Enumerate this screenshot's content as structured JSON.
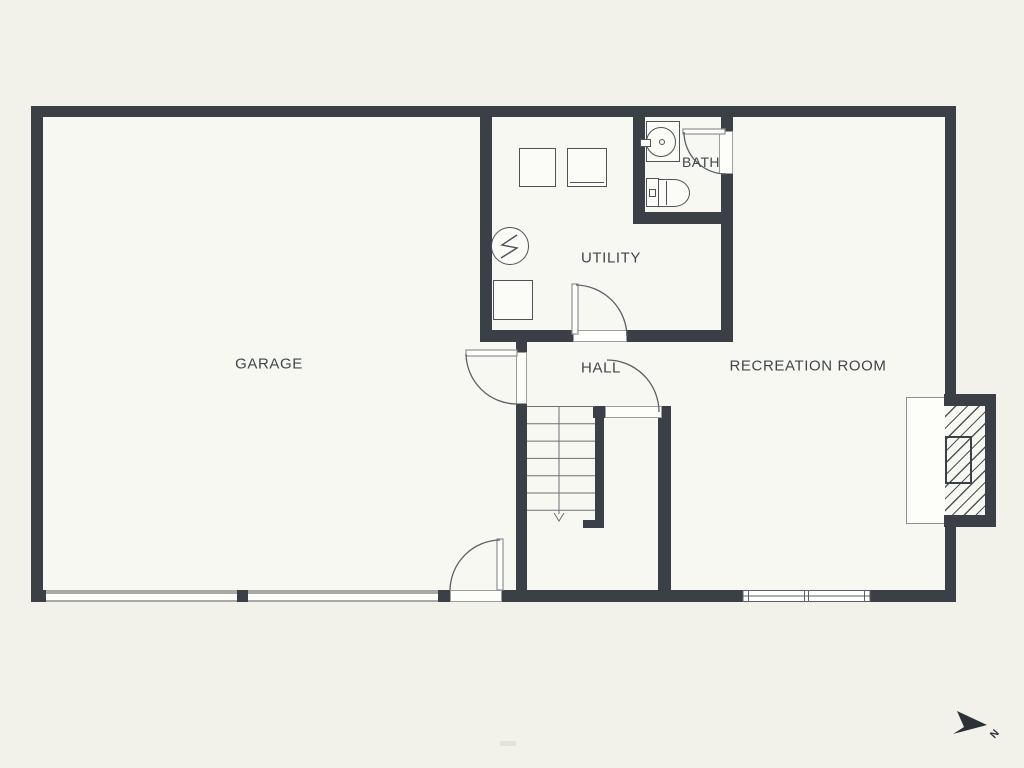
{
  "rooms": {
    "garage": {
      "label": "GARAGE"
    },
    "utility": {
      "label": "UTILITY"
    },
    "bath": {
      "label": "BATH"
    },
    "hall": {
      "label": "HALL"
    },
    "recreation": {
      "label": "RECREATION ROOM"
    }
  },
  "compass": {
    "north_label": "N",
    "icon": "north-arrow-icon",
    "direction": "pointing-right"
  },
  "fixtures": {
    "utility": [
      "washer-icon",
      "dryer-icon",
      "water-heater-icon",
      "storage-box-icon"
    ],
    "bath": [
      "sink-icon",
      "toilet-icon"
    ],
    "features": [
      "stairs-down-arrow",
      "fireplace-with-hearth",
      "garage-door-openings",
      "double-window",
      "swing-doors"
    ]
  },
  "colors": {
    "wall": "#3a4046",
    "background": "#f2f2eb",
    "floor": "#f8f8f2",
    "line": "#4d5357",
    "text": "#3f464b",
    "sill": "#a9a9a3"
  }
}
